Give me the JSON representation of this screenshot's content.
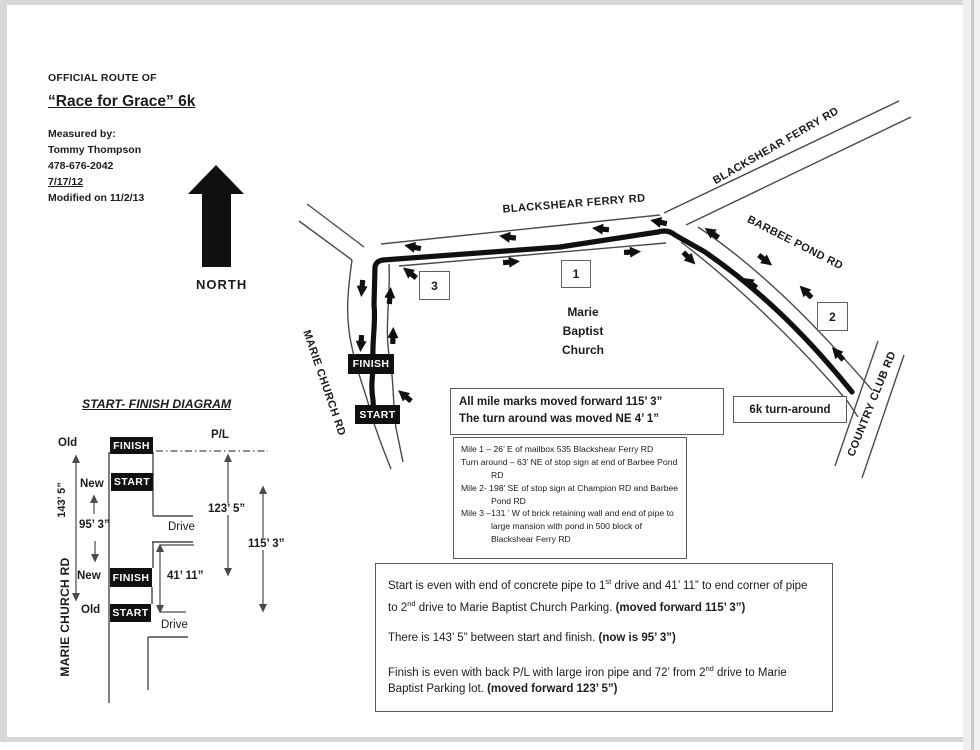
{
  "header": {
    "kicker": "OFFICIAL ROUTE OF",
    "title": "“Race for Grace” 6k",
    "measured_by": "Measured by:",
    "measurer": "Tommy Thompson",
    "phone": "478-676-2042",
    "date": "7/17/12",
    "modified": "Modified on 11/2/13"
  },
  "compass": {
    "label": "NORTH"
  },
  "map": {
    "labels": {
      "blackshear_main": "BLACKSHEAR FERRY RD",
      "blackshear_ne": "BLACKSHEAR FERRY RD",
      "barbee": "BARBEE POND RD",
      "marie_church": "MARIE CHURCH RD",
      "country_club": "COUNTRY CLUB RD"
    },
    "church": {
      "line1": "Marie",
      "line2": "Baptist",
      "line3": "Church"
    },
    "mile_markers": {
      "one": "1",
      "two": "2",
      "three": "3"
    },
    "finish_label": "FINISH",
    "start_label": "START",
    "turnaround_label": "6k turn-around"
  },
  "notes_box": {
    "line1": "All mile marks moved forward 115’ 3”",
    "line2": "The turn around was moved NE 4’ 1”"
  },
  "mile_box": {
    "items": [
      "Mile 1 – 26’ E of mailbox 535 Blackshear Ferry RD",
      "Turn around – 63’ NE of stop sign at end of Barbee Pond RD",
      "Mile 2- 198’ SE of stop sign at Champion RD and Barbee Pond RD",
      "Mile 3 –131 ’ W of brick retaining wall and end of pipe to large mansion with pond in 500 block of Blackshear Ferry RD"
    ]
  },
  "summary_box": {
    "p1": {
      "a": "Start is even with end of concrete pipe to 1",
      "a_sup": "st",
      "b": " drive and 41’ 11” to end corner of pipe to 2",
      "b_sup": "nd",
      "c": " drive to Marie Baptist Church Parking. ",
      "bold": "(moved forward 115’ 3”)"
    },
    "p2": {
      "a": "There is 143’ 5” between start and finish. ",
      "bold": "(now is 95’ 3”)"
    },
    "p3": {
      "a": "Finish is even with back P/L with large iron pipe and 72’ from 2",
      "a_sup": "nd",
      "b": " drive to Marie Baptist Parking lot. ",
      "bold": "(moved forward 123’ 5”)"
    }
  },
  "diagram": {
    "title": "START- FINISH DIAGRAM",
    "road_label": "MARIE CHURCH RD",
    "old_top": "Old",
    "old_bottom": "Old",
    "new_top": "New",
    "new_bottom": "New",
    "dim_143": "143’ 5”",
    "dim_95": "95’ 3”",
    "dim_123": "123’ 5”",
    "dim_115": "115’ 3”",
    "dim_41": "41’  11”",
    "pl_label": "P/L",
    "drive_top": "Drive",
    "drive_bottom": "Drive",
    "finish_top": "FINISH",
    "start_top": "START",
    "finish_bottom": "FINISH",
    "start_bottom": "START"
  }
}
